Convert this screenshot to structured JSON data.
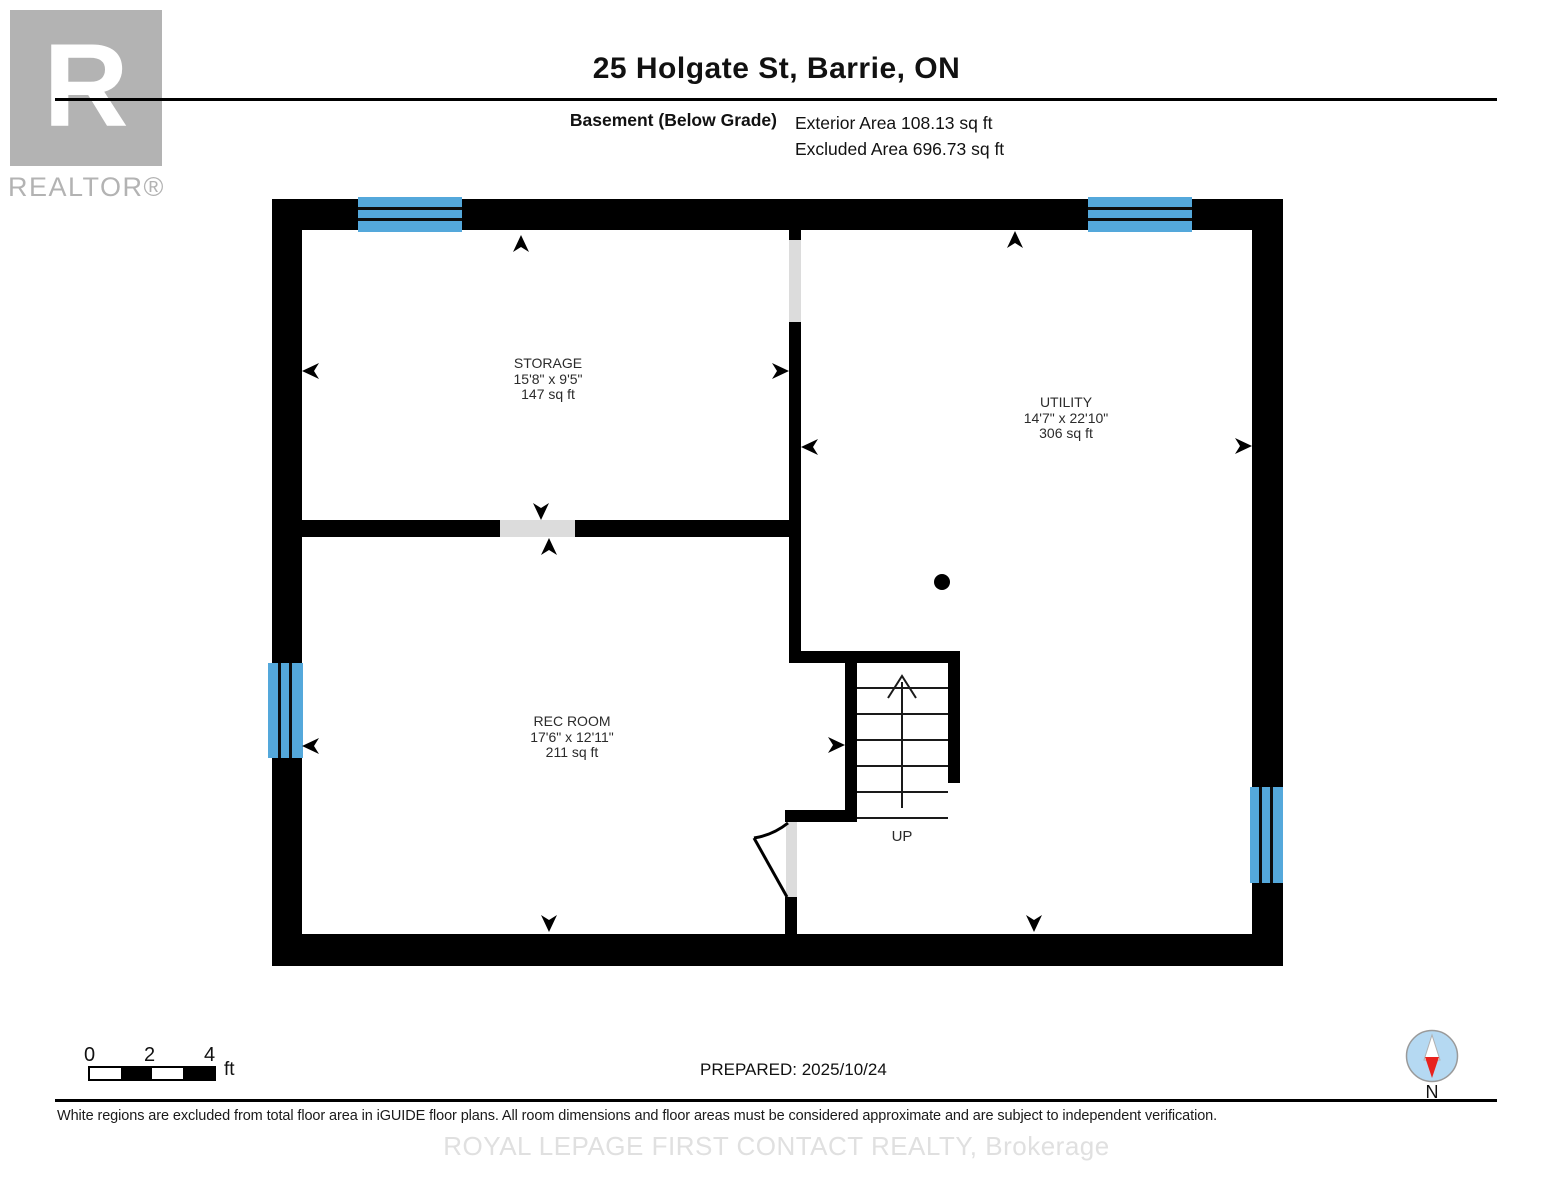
{
  "header": {
    "title": "25 Holgate St, Barrie, ON",
    "floor_label": "Basement (Below Grade)",
    "exterior_area": "Exterior Area 108.13 sq ft",
    "excluded_area": "Excluded Area 696.73 sq ft"
  },
  "logo": {
    "letter": "R",
    "label": "REALTOR®"
  },
  "floorplan": {
    "rooms": [
      {
        "name": "STORAGE",
        "dimensions": "15'8\" x 9'5\"",
        "area": "147 sq ft"
      },
      {
        "name": "UTILITY",
        "dimensions": "14'7\" x 22'10\"",
        "area": "306 sq ft"
      },
      {
        "name": "REC ROOM",
        "dimensions": "17'6\" x 12'11\"",
        "area": "211 sq ft"
      }
    ],
    "stairs_label": "UP",
    "colors": {
      "wall": "#000000",
      "window": "#54a8db",
      "door_opening": "#dcdcdc",
      "compass_blue": "#b5d9f2",
      "compass_red": "#e8221d"
    }
  },
  "scale_bar": {
    "tick0": "0",
    "tick1": "2",
    "tick2": "4",
    "unit": "ft"
  },
  "footer": {
    "prepared": "PREPARED: 2025/10/24",
    "compass_label": "N",
    "disclaimer": "White regions are excluded from total floor area in iGUIDE floor plans. All room dimensions and floor areas must be considered approximate and are subject to independent verification.",
    "brokerage": "ROYAL LEPAGE FIRST CONTACT REALTY, Brokerage"
  }
}
